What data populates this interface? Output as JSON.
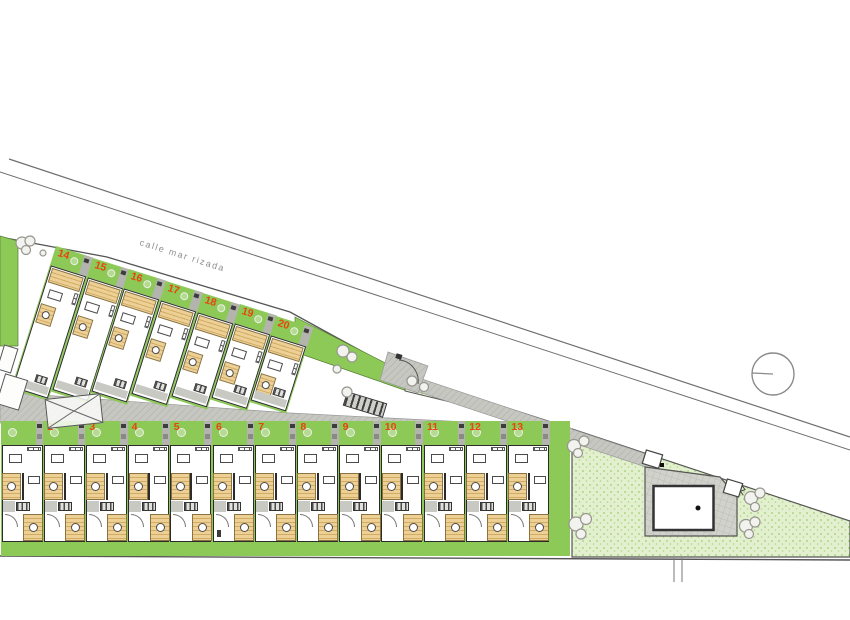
{
  "plan": {
    "street_label": "calle mar rizada",
    "upper_units": [
      "14",
      "15",
      "16",
      "17",
      "18",
      "19",
      "20"
    ],
    "lower_units": [
      "",
      "2",
      "3",
      "4",
      "5",
      "6",
      "7",
      "8",
      "9",
      "10",
      "11",
      "12",
      "13"
    ]
  },
  "colors": {
    "garden_green": "#8cc957",
    "communal_green": "#e3f0cf",
    "stipple_dot": "#aed584",
    "deck_tan": "#ecd096",
    "deck_stripe": "#d3ab63",
    "road_gray": "#c7c7c2",
    "wall_dark": "#2b2b2b",
    "unit_number": "#e8440e",
    "line_gray": "#8a8a8a"
  }
}
